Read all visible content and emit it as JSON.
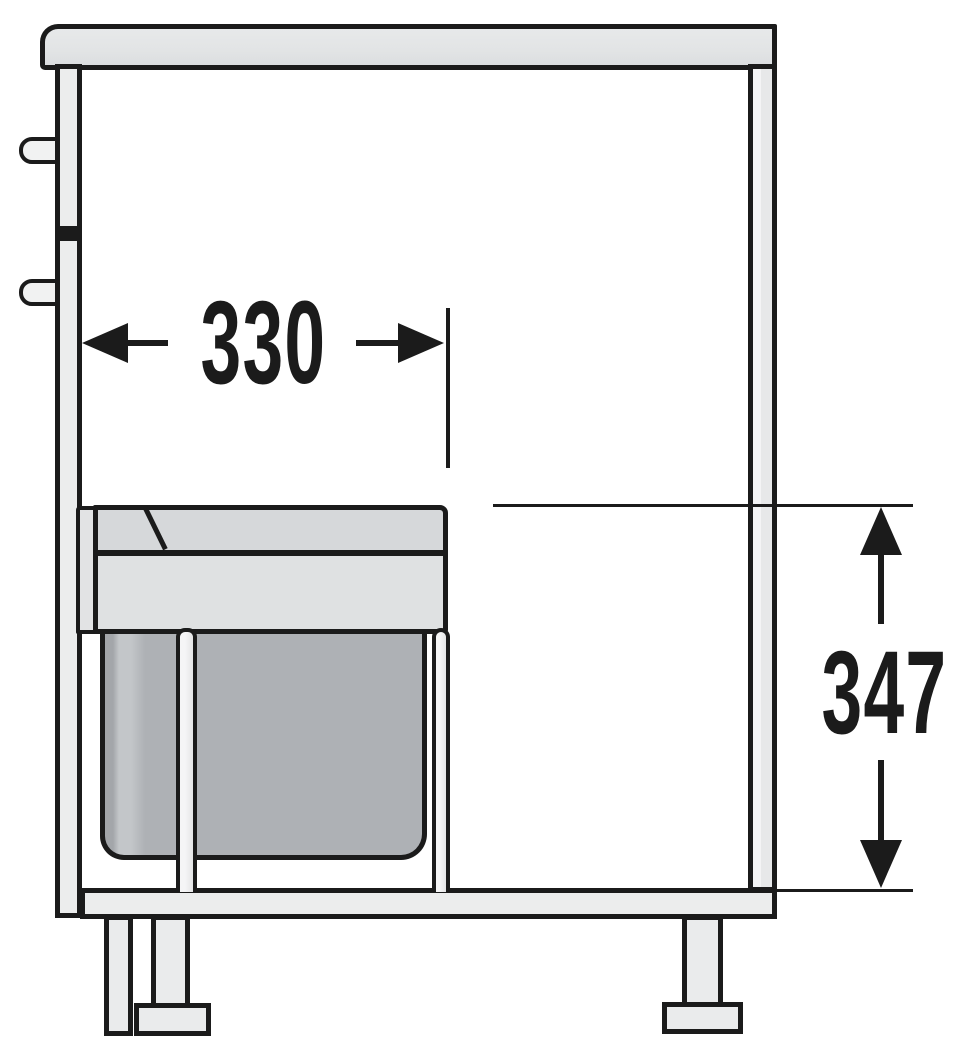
{
  "diagram": {
    "type": "technical-dimension-drawing",
    "subject": "base cabinet cross-section with pull-out waste bin",
    "dimensions": {
      "width": {
        "label": "330",
        "value": 330,
        "orientation": "horizontal"
      },
      "height": {
        "label": "347",
        "value": 347,
        "orientation": "vertical"
      }
    },
    "colors": {
      "background": "#ffffff",
      "outline": "#1b1b1b",
      "countertop": "#e2e4e5",
      "panel": "#eceded",
      "lid_top": "#d6d8da",
      "lid_frame": "#dfe1e2",
      "bin_body": "#aeb1b5"
    }
  }
}
